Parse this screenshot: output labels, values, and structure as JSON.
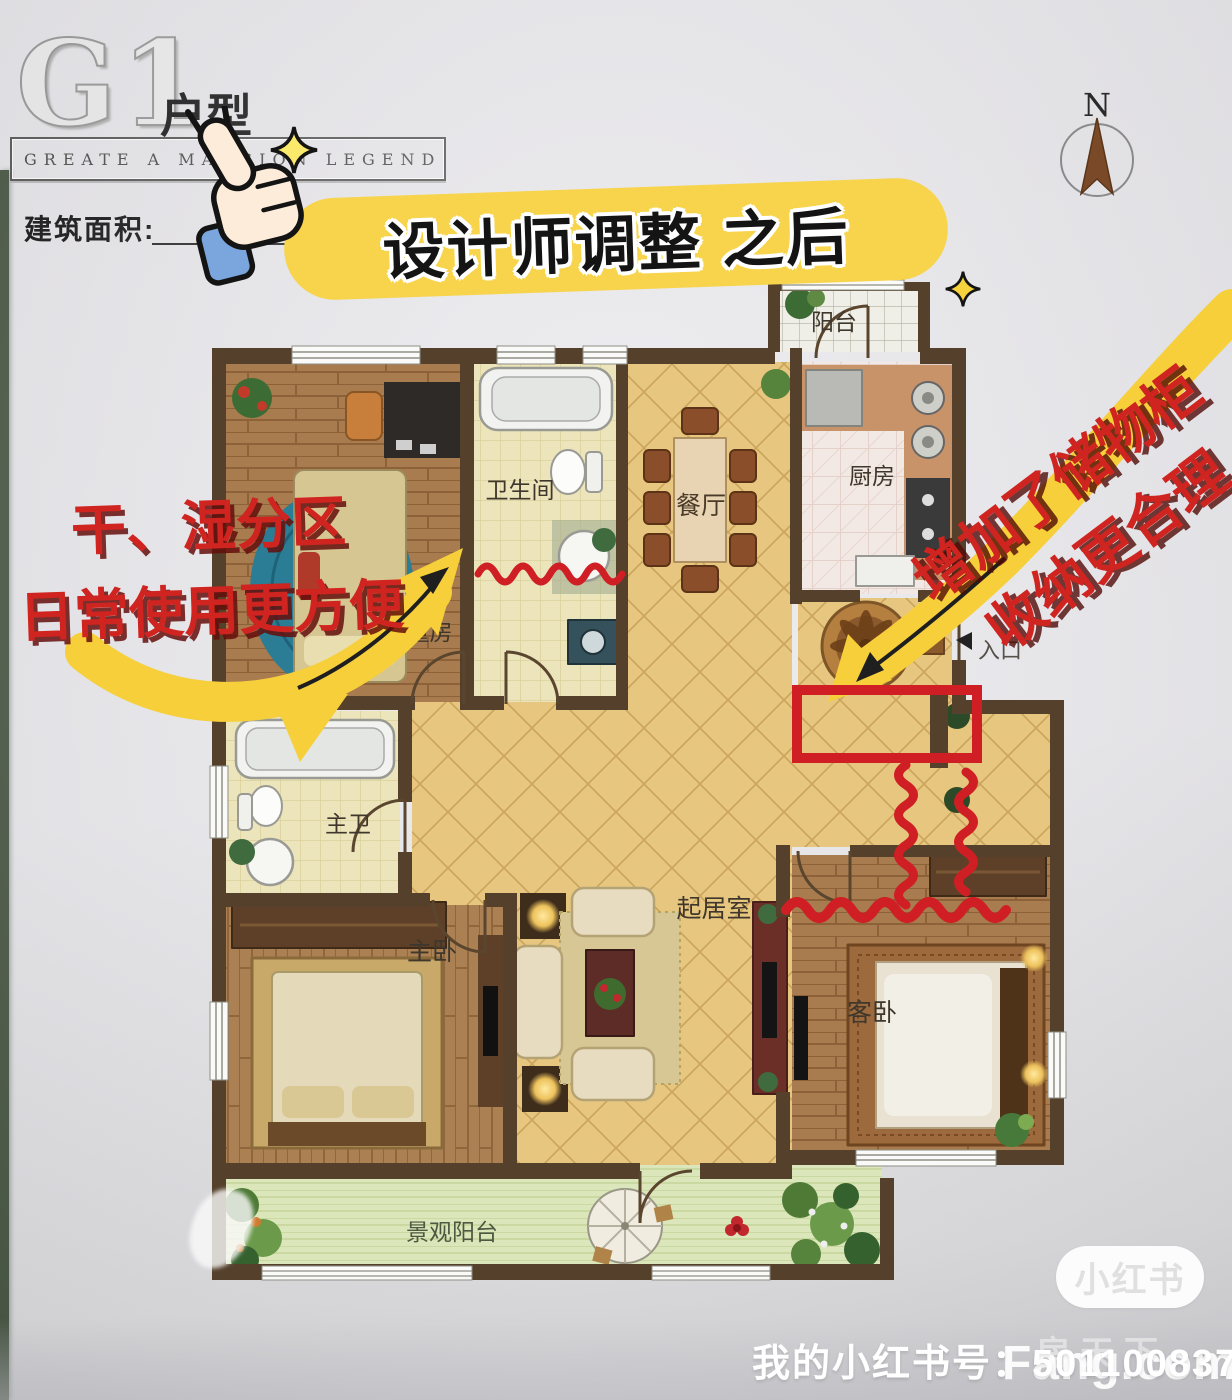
{
  "header": {
    "unit_code": "G1",
    "unit_label": "户型",
    "tagline": "GREATE A MANSION LEGEND",
    "area_label": "建筑面积:",
    "compass_n": "N"
  },
  "banner": {
    "text": "设计师调整 之后"
  },
  "notes": {
    "left_line1": "干、湿分区",
    "left_line2": "日常使用更方便",
    "right_line1": "增加了储物柜",
    "right_line2": "收纳更合理"
  },
  "rooms": {
    "balcony_top": "阳台",
    "kitchen": "厨房",
    "dining": "餐厅",
    "bath": "卫生间",
    "kids": "儿童房",
    "entrance": "入口",
    "master_bath": "主卫",
    "master_bedroom": "主卧",
    "living": "起居室",
    "guest_bedroom": "客卧",
    "view_balcony": "景观阳台"
  },
  "footer": {
    "badge": "小红书",
    "id_label": "我的小红书号：",
    "id_value": "501100837",
    "watermark_cn": "房天下",
    "watermark_en": "Fang.com"
  },
  "colors": {
    "annotation_red": "#cf2420",
    "highlight_yellow": "#f6cf3a",
    "wall_brown": "#54402b",
    "tile_yellow": "#e7c77f"
  }
}
